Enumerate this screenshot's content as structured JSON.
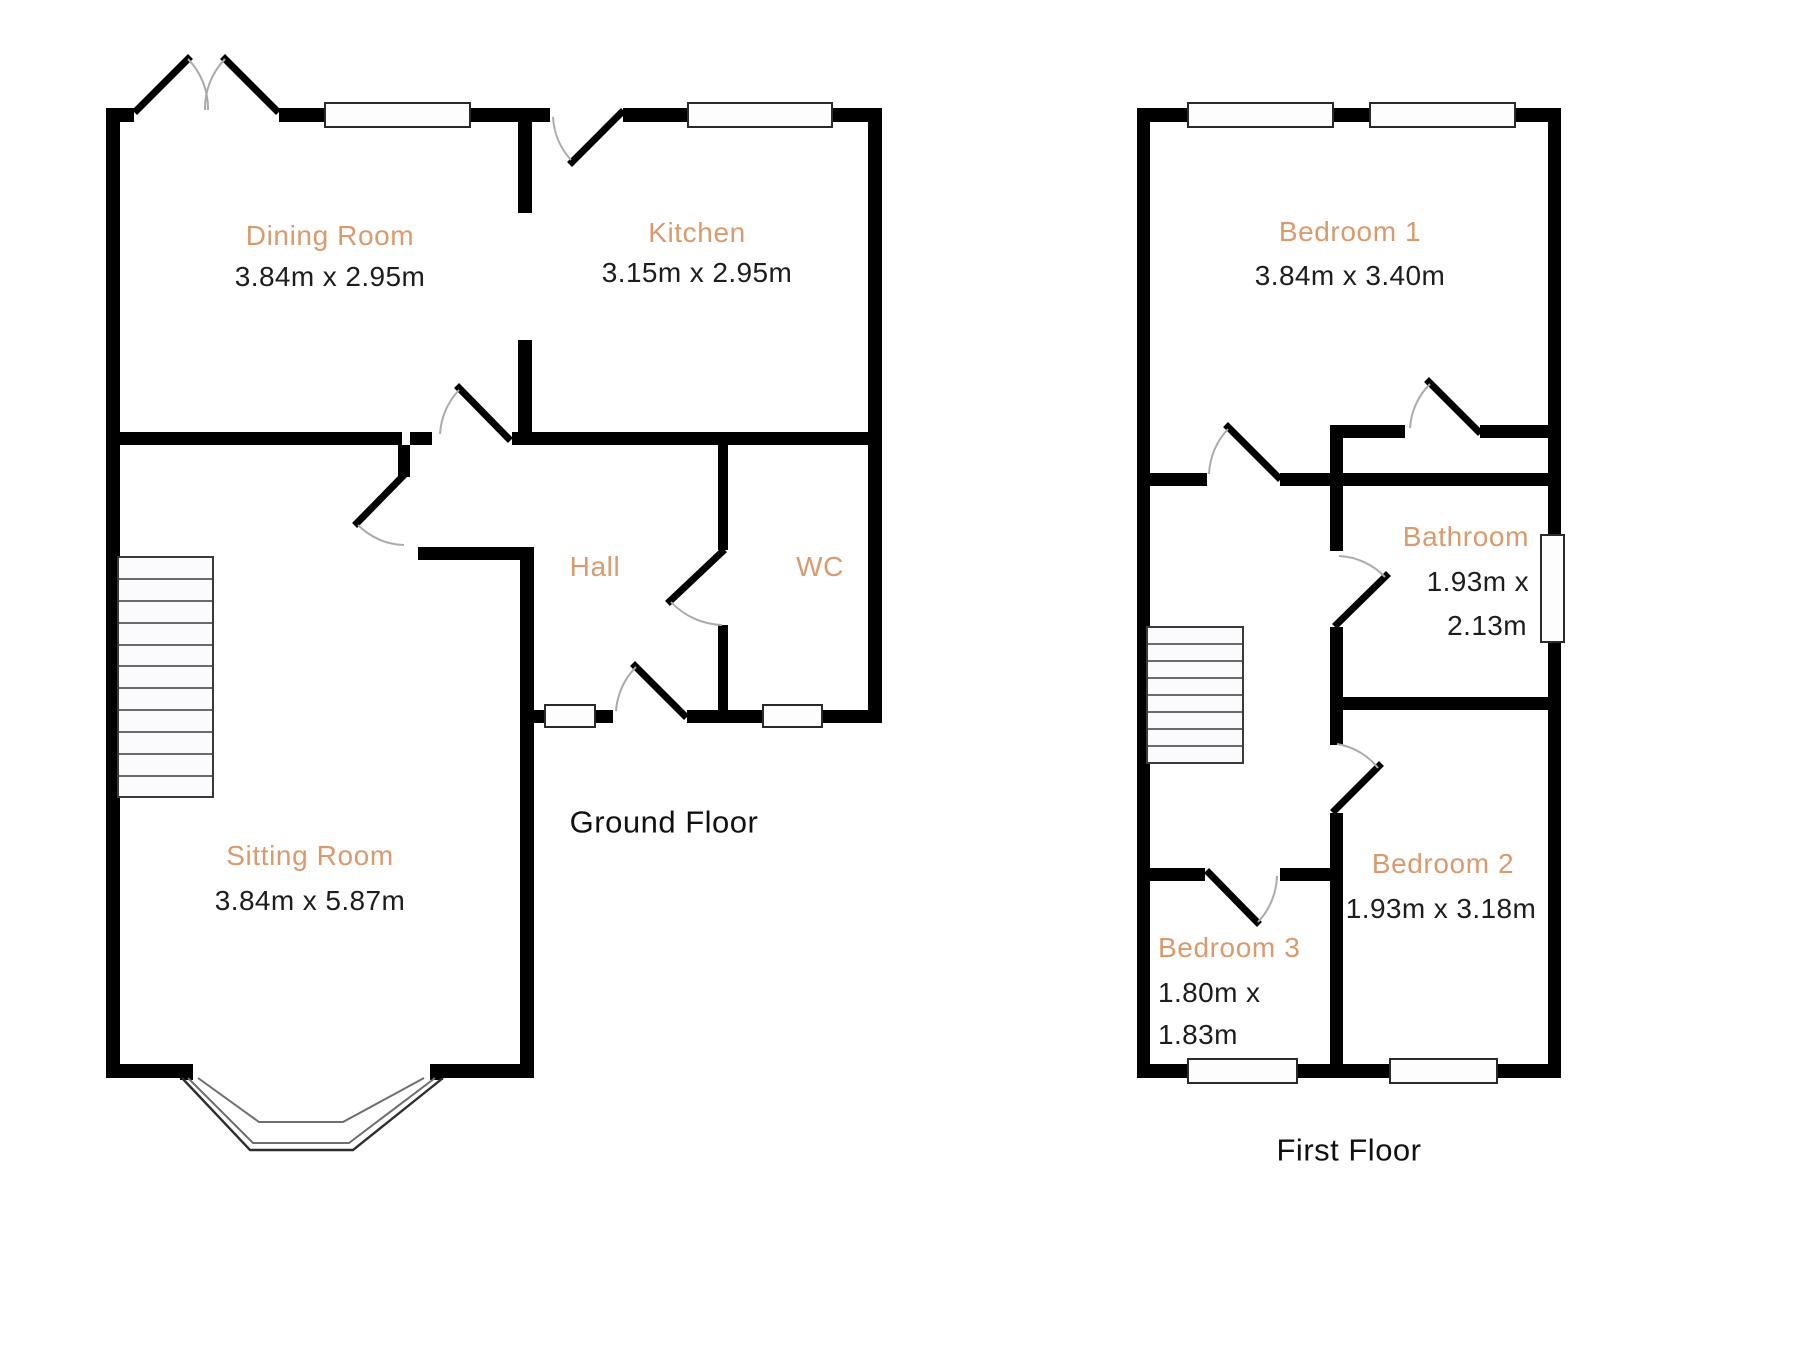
{
  "colors": {
    "room_label": "#DB9A6C",
    "dimension_text": "#1D1D1B",
    "floor_title": "#111111",
    "wall": "#000000",
    "door_arc": "#ABABAB"
  },
  "ground_floor": {
    "title": "Ground Floor",
    "rooms": {
      "dining": {
        "name": "Dining Room",
        "dims": "3.84m x 2.95m"
      },
      "kitchen": {
        "name": "Kitchen",
        "dims": "3.15m x 2.95m"
      },
      "hall": {
        "name": "Hall"
      },
      "wc": {
        "name": "WC"
      },
      "sitting": {
        "name": "Sitting Room",
        "dims": "3.84m x 5.87m"
      }
    }
  },
  "first_floor": {
    "title": "First Floor",
    "rooms": {
      "bedroom1": {
        "name": "Bedroom 1",
        "dims": "3.84m x 3.40m"
      },
      "bathroom": {
        "name": "Bathroom",
        "dims_line1": "1.93m x",
        "dims_line2": "2.13m"
      },
      "bedroom2": {
        "name": "Bedroom 2",
        "dims": "1.93m x 3.18m"
      },
      "bedroom3": {
        "name": "Bedroom 3",
        "dims_line1": "1.80m x",
        "dims_line2": "1.83m"
      }
    }
  }
}
